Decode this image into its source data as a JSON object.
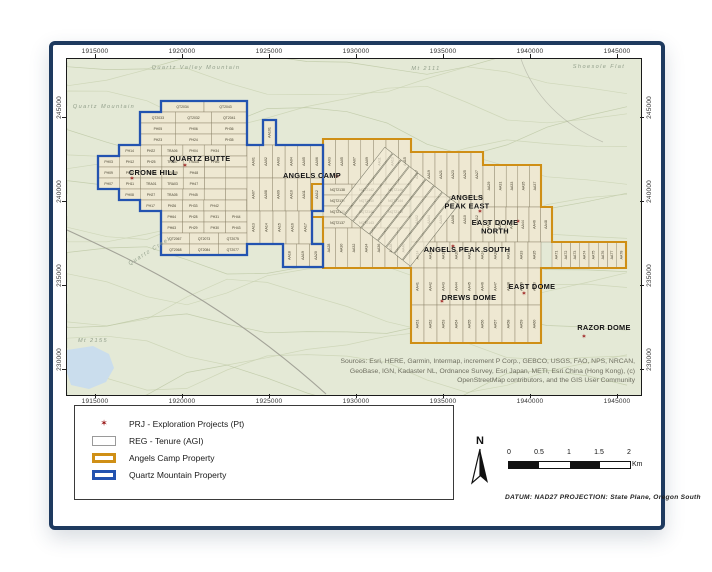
{
  "page": {
    "north_label": "N",
    "datum_note": "DATUM:  NAD27 PROJECTION: State Plane, Oregon South",
    "scale": {
      "ticks": [
        "0",
        "0.5",
        "1",
        "1.5",
        "2"
      ],
      "unit": "Km"
    }
  },
  "axes": {
    "top": [
      "1915000",
      "1920000",
      "1925000",
      "1930000",
      "1935000",
      "1940000",
      "1945000"
    ],
    "bottom": [
      "1915000",
      "1920000",
      "1925000",
      "1930000",
      "1935000",
      "1940000",
      "1945000"
    ],
    "left": [
      "245000",
      "240000",
      "235000",
      "230000"
    ],
    "right": [
      "245000",
      "240000",
      "235000",
      "230000"
    ]
  },
  "legend": {
    "items": [
      {
        "key": "prj",
        "label": "PRJ - Exploration Projects (Pt)"
      },
      {
        "key": "tenure",
        "label": "REG - Tenure (AGI)"
      },
      {
        "key": "angels",
        "label": "Angels Camp Property"
      },
      {
        "key": "quartz",
        "label": "Quartz Mountain Property"
      }
    ]
  },
  "map": {
    "attribution": "Sources: Esri, HERE, Garmin, Intermap, increment P Corp., GEBCO, USGS, FAO, NPS, NRCAN, GeoBase, IGN, Kadaster NL, Ordnance Survey, Esri Japan, METI, Esri China (Hong Kong), (c) OpenStreetMap contributors, and the GIS User Community",
    "colors": {
      "basemap": "#e4e9d6",
      "contour": "#c9d2b2",
      "contour_dark": "#bcc7a3",
      "lake": "#cadded",
      "road": "#a3a398",
      "cell_fill": "#eee8d2",
      "cell_stroke": "#8a8268",
      "cell_text": "#46412f",
      "angels_outline": "#cf8f16",
      "quartz_outline": "#2353b0",
      "star": "#9b1b1b",
      "place_text": "#111111",
      "terrain_text": "#93a08c"
    },
    "terrain_labels": [
      {
        "text": "Quartz Valley Mountain",
        "x": 195,
        "y": 67,
        "rot": 0
      },
      {
        "text": "Mt 2111",
        "x": 425,
        "y": 68,
        "rot": 0
      },
      {
        "text": "Shoesole Flat",
        "x": 598,
        "y": 66,
        "rot": 0
      },
      {
        "text": "Quartz Mountain",
        "x": 103,
        "y": 106,
        "rot": 0
      },
      {
        "text": "Quartz Creek",
        "x": 150,
        "y": 250,
        "rot": -32
      },
      {
        "text": "Mt 2155",
        "x": 92,
        "y": 340,
        "rot": 0
      }
    ],
    "place_labels": [
      {
        "lines": [
          "QUARTZ BUTTE"
        ],
        "x": 199,
        "y": 159
      },
      {
        "lines": [
          "CRONE HILL"
        ],
        "x": 152,
        "y": 173
      },
      {
        "lines": [
          "ANGELS CAMP"
        ],
        "x": 311,
        "y": 176
      },
      {
        "lines": [
          "ANGELS",
          "PEAK EAST"
        ],
        "x": 466,
        "y": 198
      },
      {
        "lines": [
          "EAST DOME",
          "NORTH"
        ],
        "x": 494,
        "y": 223
      },
      {
        "lines": [
          "ANGELS PEAK SOUTH"
        ],
        "x": 466,
        "y": 250
      },
      {
        "lines": [
          "EAST DOME"
        ],
        "x": 531,
        "y": 287
      },
      {
        "lines": [
          "DREWS DOME"
        ],
        "x": 468,
        "y": 298
      },
      {
        "lines": [
          "RAZOR DOME"
        ],
        "x": 603,
        "y": 328
      }
    ],
    "project_points": [
      {
        "x": 184,
        "y": 163
      },
      {
        "x": 131,
        "y": 176
      },
      {
        "x": 336,
        "y": 174
      },
      {
        "x": 479,
        "y": 209
      },
      {
        "x": 517,
        "y": 219
      },
      {
        "x": 452,
        "y": 244
      },
      {
        "x": 523,
        "y": 291
      },
      {
        "x": 441,
        "y": 299
      },
      {
        "x": 583,
        "y": 334
      }
    ],
    "properties": {
      "quartz_mountain": {
        "name": "Quartz Mountain Property",
        "path": "M160,99 H246 V143 H262 V118 H275 V143 H322 V209 H311 V242 H322 V265 H282 V242 H246 V253 H160 V209 H139 V198 H118 V187 H97 V154 H118 V143 H139 V110 H160 Z"
      },
      "angels_camp": {
        "name": "Angels Camp Property",
        "path": "M322,137 H410 V150 H482 V163 H540 V205 H551 V240 H625 V266 H540 V341 H410 V266 H322 V215 H311 V182 H322 Z"
      }
    },
    "claim_bands_h": [
      {
        "x": 160,
        "y": 99,
        "w": 43,
        "h": 11,
        "labels": [
          "QT2034",
          "QT2043"
        ]
      },
      {
        "x": 139,
        "y": 110,
        "w": 35.7,
        "h": 11,
        "labels": [
          "QT2033",
          "QT2032",
          "QT2041"
        ]
      },
      {
        "x": 139,
        "y": 121,
        "w": 35.7,
        "h": 11,
        "labels": [
          "PH05",
          "PH06",
          "PH36"
        ]
      },
      {
        "x": 139,
        "y": 132,
        "w": 35.7,
        "h": 11,
        "labels": [
          "PH23",
          "PH24",
          "PH35"
        ]
      },
      {
        "x": 118,
        "y": 143,
        "w": 21.3,
        "h": 11,
        "labels": [
          "PH14",
          "PH22",
          "TRA06",
          "PH04",
          "PH34",
          ""
        ]
      },
      {
        "x": 97,
        "y": 154,
        "w": 21.3,
        "h": 11,
        "labels": [
          "PH03",
          "PH12",
          "PH25",
          "TRA07",
          "TRA08",
          "PH46",
          ""
        ]
      },
      {
        "x": 97,
        "y": 165,
        "w": 21.3,
        "h": 11,
        "labels": [
          "PH09",
          "PH10",
          "TRA02",
          "TRA09",
          "PH48",
          "",
          ""
        ]
      },
      {
        "x": 97,
        "y": 176,
        "w": 21.3,
        "h": 11,
        "labels": [
          "PH07",
          "PH11",
          "TRA01",
          "TRA03",
          "PH47",
          "",
          ""
        ]
      },
      {
        "x": 118,
        "y": 187,
        "w": 21.3,
        "h": 11,
        "labels": [
          "PH08",
          "PH27",
          "TRA05",
          "PH45",
          "",
          ""
        ]
      },
      {
        "x": 139,
        "y": 198,
        "w": 21.3,
        "h": 11,
        "labels": [
          "PH17",
          "PH26",
          "PH33",
          "PH42",
          ""
        ]
      },
      {
        "x": 160,
        "y": 209,
        "w": 21.5,
        "h": 11,
        "labels": [
          "PH64",
          "PH28",
          "PH31",
          "PH44"
        ]
      },
      {
        "x": 160,
        "y": 220,
        "w": 21.5,
        "h": 11,
        "labels": [
          "PH63",
          "PH29",
          "PH30",
          "PH43"
        ]
      },
      {
        "x": 160,
        "y": 231,
        "w": 28.7,
        "h": 11,
        "labels": [
          "QT2067",
          "QT2073",
          "QT2075"
        ]
      },
      {
        "x": 160,
        "y": 242,
        "w": 28.7,
        "h": 11,
        "labels": [
          "QT2068",
          "QT2084",
          "QT2077"
        ]
      },
      {
        "x": 322,
        "y": 182,
        "w": 29,
        "h": 11,
        "labels": [
          "NQT2138",
          "NQT2142",
          "NQT2146"
        ]
      },
      {
        "x": 322,
        "y": 193,
        "w": 29,
        "h": 11,
        "labels": [
          "NQT2136",
          "NQT2140",
          "NQT2144"
        ]
      },
      {
        "x": 322,
        "y": 204,
        "w": 29,
        "h": 11,
        "labels": [
          "NQT2135",
          "NQT2141",
          "NQT2145"
        ]
      },
      {
        "x": 322,
        "y": 215,
        "w": 29,
        "h": 11,
        "labels": [
          "NQT2137",
          "NQT2143",
          ""
        ]
      }
    ],
    "claim_bands_v": [
      {
        "x": 262,
        "y": 118,
        "w": 13,
        "h": 25,
        "labels": [
          "AA101"
        ]
      },
      {
        "x": 246,
        "y": 143,
        "w": 12.7,
        "h": 33,
        "labels": [
          "AA01",
          "AA02",
          "AA03",
          "AA04",
          "AA05",
          "AA06"
        ]
      },
      {
        "x": 246,
        "y": 176,
        "w": 12.7,
        "h": 33,
        "labels": [
          "AA07",
          "AA08",
          "AA09",
          "AA10",
          "AA11",
          "AA12"
        ]
      },
      {
        "x": 246,
        "y": 209,
        "w": 13,
        "h": 33,
        "labels": [
          "AA13",
          "AA14",
          "AA15",
          "AA16",
          "AA17"
        ]
      },
      {
        "x": 282,
        "y": 242,
        "w": 13.3,
        "h": 23,
        "labels": [
          "AA18",
          "AA19",
          "AA20"
        ]
      },
      {
        "x": 322,
        "y": 137,
        "w": 12.6,
        "h": 45,
        "labels": [
          "AA03",
          "AA05",
          "AA07",
          "AA09",
          "AA11",
          "AA13",
          "AA15"
        ]
      },
      {
        "x": 410,
        "y": 150,
        "w": 12,
        "h": 45,
        "labels": [
          "AA17",
          "AA19",
          "AA21",
          "AA23",
          "AA25",
          "AA27"
        ]
      },
      {
        "x": 482,
        "y": 163,
        "w": 11.6,
        "h": 42,
        "labels": [
          "AA29",
          "AA31",
          "AA33",
          "AA35",
          "AA37"
        ]
      },
      {
        "x": 410,
        "y": 195,
        "w": 12,
        "h": 45,
        "labels": [
          "AA02",
          "AA04",
          "AA06",
          "AA08",
          "AA10",
          "AA12"
        ]
      },
      {
        "x": 482,
        "y": 205,
        "w": 11.5,
        "h": 35,
        "labels": [
          "AA39",
          "AA40",
          "AA42",
          "AA44",
          "AA46",
          "AA48"
        ]
      },
      {
        "x": 322,
        "y": 226,
        "w": 12.4,
        "h": 40,
        "labels": [
          "AA28",
          "AA30",
          "AA32",
          "AA34",
          "AA36",
          "AA38",
          "AA40"
        ]
      },
      {
        "x": 410,
        "y": 240,
        "w": 13,
        "h": 26,
        "labels": [
          "AA14",
          "AA16",
          "AA18",
          "AA20",
          "AA22",
          "AA24",
          "AA26",
          "AA31",
          "AA33",
          "AA35"
        ]
      },
      {
        "x": 410,
        "y": 266,
        "w": 13,
        "h": 37,
        "labels": [
          "AA41",
          "AA42",
          "AA43",
          "AA44",
          "AA45",
          "AA46",
          "AA47",
          "AA48",
          "AA49",
          "AA50"
        ]
      },
      {
        "x": 410,
        "y": 303,
        "w": 13,
        "h": 38,
        "labels": [
          "AA51",
          "AA52",
          "AA53",
          "AA54",
          "AA55",
          "AA56",
          "AA57",
          "AA58",
          "AA59",
          "AA60"
        ]
      },
      {
        "x": 551,
        "y": 240,
        "w": 9.25,
        "h": 26,
        "labels": [
          "AA71",
          "AA72",
          "AA73",
          "AA74",
          "AA75",
          "AA76",
          "AA77",
          "AA78"
        ]
      }
    ],
    "diagonal_claims": {
      "cx": 397,
      "cy": 205,
      "rot": 38,
      "strips": 9,
      "strip_w": 9.5,
      "strip_h": 78,
      "gap": 10.5
    }
  }
}
